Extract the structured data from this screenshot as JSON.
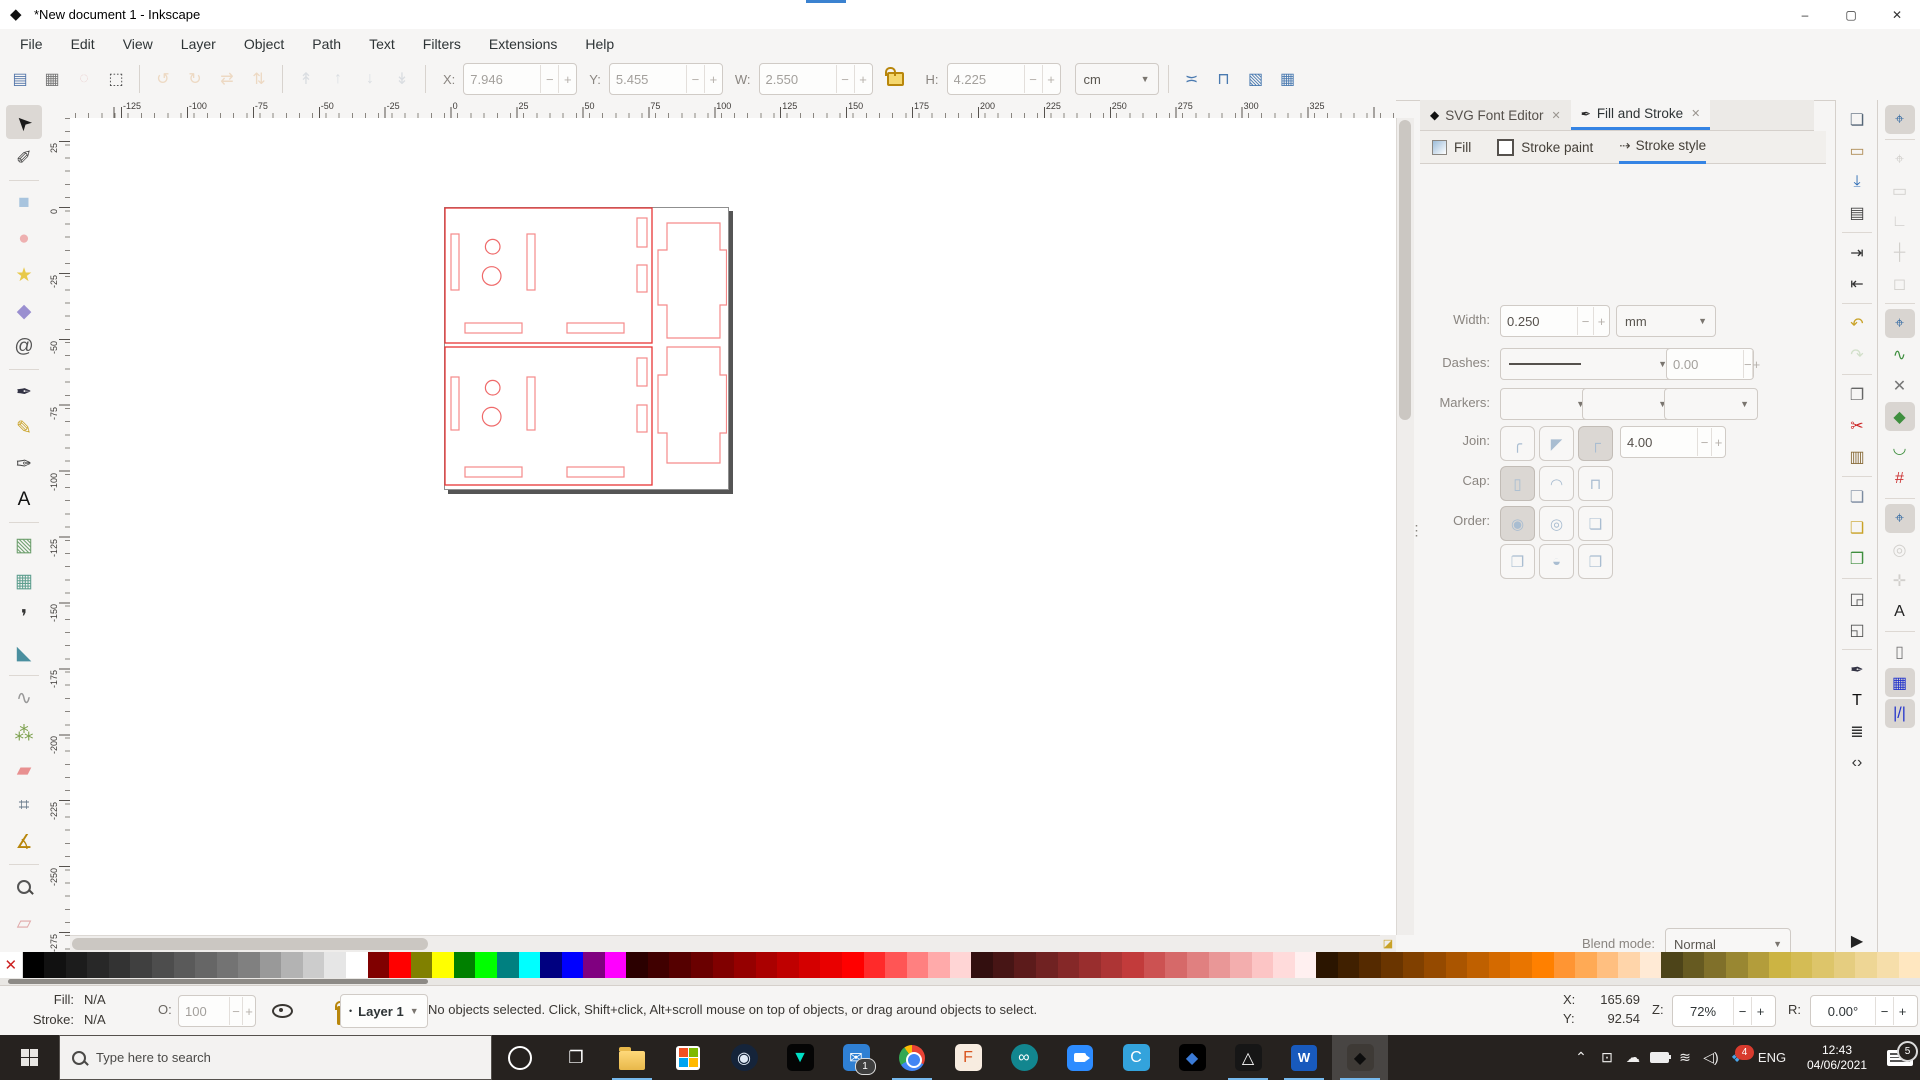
{
  "window": {
    "title": "*New document 1 - Inkscape",
    "minimize": "–",
    "maximize": "▢",
    "close": "✕"
  },
  "menubar": [
    "File",
    "Edit",
    "View",
    "Layer",
    "Object",
    "Path",
    "Text",
    "Filters",
    "Extensions",
    "Help"
  ],
  "toolbar": {
    "select_icons": [
      {
        "name": "select-all-icon",
        "glyph": "▤",
        "color": "#5577aa"
      },
      {
        "name": "select-all-layers-icon",
        "glyph": "▦",
        "color": "#777777"
      },
      {
        "name": "deselect-icon",
        "glyph": "◌",
        "color": "#d9a0a0",
        "disabled": true
      },
      {
        "name": "selection-box-icon",
        "glyph": "⬚",
        "color": "#444444"
      }
    ],
    "transform_icons": [
      {
        "name": "rotate-ccw-icon",
        "glyph": "↺",
        "color": "#e3b98a",
        "disabled": true
      },
      {
        "name": "rotate-cw-icon",
        "glyph": "↻",
        "color": "#e3b98a",
        "disabled": true
      },
      {
        "name": "flip-horizontal-icon",
        "glyph": "⇄",
        "color": "#e3b98a",
        "disabled": true
      },
      {
        "name": "flip-vertical-icon",
        "glyph": "⇅",
        "color": "#e3b98a",
        "disabled": true
      }
    ],
    "arrange_icons": [
      {
        "name": "raise-to-top-icon",
        "glyph": "↟",
        "color": "#b9c2cc",
        "disabled": true
      },
      {
        "name": "raise-icon",
        "glyph": "↑",
        "color": "#b9c2cc",
        "disabled": true
      },
      {
        "name": "lower-icon",
        "glyph": "↓",
        "color": "#b9c2cc",
        "disabled": true
      },
      {
        "name": "lower-to-bottom-icon",
        "glyph": "↡",
        "color": "#b9c2cc",
        "disabled": true
      }
    ],
    "fields": [
      {
        "label": "X:",
        "value": "7.946"
      },
      {
        "label": "Y:",
        "value": "5.455"
      },
      {
        "label": "W:",
        "value": "2.550"
      },
      {
        "label": "H:",
        "value": "4.225"
      }
    ],
    "unit": "cm",
    "affect_icons": [
      {
        "name": "scale-stroke-toggle-icon",
        "glyph": "≍",
        "color": "#4a7ab0"
      },
      {
        "name": "scale-corners-toggle-icon",
        "glyph": "⊓",
        "color": "#4a7ab0"
      },
      {
        "name": "move-gradients-toggle-icon",
        "glyph": "▧",
        "color": "#4a7ab0"
      },
      {
        "name": "move-patterns-toggle-icon",
        "glyph": "▦",
        "color": "#4a7ab0"
      }
    ]
  },
  "rulers": {
    "h_labels": [
      "-125",
      "-100",
      "-75",
      "-50",
      "-25",
      "0",
      "25",
      "50",
      "75",
      "100",
      "125",
      "150",
      "175",
      "200",
      "225",
      "250",
      "275",
      "300",
      "325"
    ],
    "v_labels": [
      "25",
      "0",
      "-25",
      "-50",
      "-75",
      "-100",
      "-125",
      "-150",
      "-175",
      "-200",
      "-225",
      "-250",
      "-275"
    ]
  },
  "toolbox": [
    {
      "name": "selector-tool",
      "glyph": "➤",
      "color": "#1a1a1a",
      "selected": true,
      "rot": true
    },
    {
      "name": "node-tool",
      "glyph": "✐",
      "color": "#444444"
    },
    {
      "sep": true
    },
    {
      "name": "rectangle-tool",
      "glyph": "■",
      "color": "#a8c4de"
    },
    {
      "name": "ellipse-tool",
      "glyph": "●",
      "color": "#eeb0b0"
    },
    {
      "name": "star-tool",
      "glyph": "★",
      "color": "#e8c94a"
    },
    {
      "name": "box3d-tool",
      "glyph": "◆",
      "color": "#9a8fd0"
    },
    {
      "name": "spiral-tool",
      "glyph": "@",
      "color": "#555555"
    },
    {
      "sep": true
    },
    {
      "name": "pen-tool",
      "glyph": "✒",
      "color": "#333344"
    },
    {
      "name": "pencil-tool",
      "glyph": "✎",
      "color": "#c9a227"
    },
    {
      "name": "calligraphy-tool",
      "glyph": "✑",
      "color": "#444444"
    },
    {
      "name": "text-tool",
      "glyph": "A",
      "color": "#111111"
    },
    {
      "sep": true
    },
    {
      "name": "gradient-tool",
      "glyph": "▧",
      "color": "#6fa06f"
    },
    {
      "name": "mesh-tool",
      "glyph": "▦",
      "color": "#5f9f8f"
    },
    {
      "name": "dropper-tool",
      "glyph": "❜",
      "color": "#333333"
    },
    {
      "name": "bucket-tool",
      "glyph": "◣",
      "color": "#4a8f9f"
    },
    {
      "sep": true
    },
    {
      "name": "tweak-tool",
      "glyph": "∿",
      "color": "#999999"
    },
    {
      "name": "spray-tool",
      "glyph": "⁂",
      "color": "#7a9f4a"
    },
    {
      "name": "eraser-tool",
      "glyph": "▰",
      "color": "#e89090"
    },
    {
      "name": "connector-tool",
      "glyph": "⌗",
      "color": "#667788"
    },
    {
      "name": "compass-tool",
      "glyph": "∡",
      "color": "#b8860b"
    },
    {
      "sep": true
    },
    {
      "name": "zoom-tool",
      "glyph": "MAG",
      "color": "#555555"
    },
    {
      "name": "measure-tool",
      "glyph": "▱",
      "color": "#e0a8a8"
    }
  ],
  "drawing": {
    "page_w": 283,
    "page_h": 281,
    "stroke_main": "#e83535",
    "stroke_light": "#f58a8a",
    "stroke_mid": "#ef6a6a",
    "panels": [
      [
        1,
        1,
        207,
        135
      ],
      [
        1,
        140,
        207,
        138
      ]
    ],
    "slots": [
      [
        7,
        27,
        8,
        56
      ],
      [
        83,
        27,
        8,
        56
      ],
      [
        21,
        116,
        57,
        10
      ],
      [
        123,
        116,
        57,
        10
      ],
      [
        193,
        11,
        10,
        29
      ],
      [
        193,
        58,
        10,
        27
      ],
      [
        7,
        170,
        8,
        53
      ],
      [
        83,
        170,
        8,
        53
      ],
      [
        21,
        260,
        57,
        10
      ],
      [
        123,
        260,
        57,
        10
      ],
      [
        193,
        151,
        10,
        28
      ],
      [
        193,
        198,
        10,
        27
      ]
    ],
    "circles": [
      [
        48.7,
        39.7,
        7.3
      ],
      [
        47.7,
        69,
        9.3
      ],
      [
        48.7,
        180.7,
        7.3
      ],
      [
        47.7,
        209.7,
        9.3
      ]
    ],
    "pluses": [
      "M223,16 H276 V43 H282.5 V98 H276 V131 H223 V98 H214 V43 H223 Z",
      "M223,140 H276 V168 H282.5 V226 H276 V256 H223 V226 H214 V168 H223 Z"
    ]
  },
  "dock": {
    "tabs": [
      {
        "label": "SVG Font Editor",
        "icon": "inkscape-logo-icon",
        "icon_glyph": "◆",
        "close": "✕",
        "active": false
      },
      {
        "label": "Fill and Stroke",
        "icon": "fill-stroke-pen-icon",
        "icon_glyph": "✒",
        "close": "✕",
        "active": true
      }
    ],
    "subtabs": [
      {
        "label": "Fill",
        "kind": "grad"
      },
      {
        "label": "Stroke paint",
        "kind": "line"
      },
      {
        "label": "Stroke style",
        "kind": "dash",
        "active": true
      }
    ],
    "stroke": {
      "width_label": "Width:",
      "width_value": "0.250",
      "width_unit": "mm",
      "dashes_label": "Dashes:",
      "dash_offset": "0.00",
      "markers_label": "Markers:",
      "join_label": "Join:",
      "miter_limit": "4.00",
      "join_buttons": [
        {
          "name": "join-round-button",
          "glyph": "╭"
        },
        {
          "name": "join-bevel-button",
          "glyph": "◤"
        },
        {
          "name": "join-miter-button",
          "glyph": "┌",
          "pressed": true
        }
      ],
      "cap_label": "Cap:",
      "cap_buttons": [
        {
          "name": "cap-butt-button",
          "glyph": "▯",
          "pressed": true
        },
        {
          "name": "cap-round-button",
          "glyph": "◠"
        },
        {
          "name": "cap-square-button",
          "glyph": "⊓"
        }
      ],
      "order_label": "Order:",
      "order_buttons": [
        {
          "name": "order-fill-stroke-markers-button",
          "glyph": "◉",
          "pressed": true
        },
        {
          "name": "order-stroke-fill-markers-button",
          "glyph": "◎"
        },
        {
          "name": "order-markers-fill-stroke-button",
          "glyph": "❏"
        },
        {
          "name": "order-fill-markers-stroke-button",
          "glyph": "❐"
        },
        {
          "name": "order-stroke-markers-fill-button",
          "glyph": "◒"
        },
        {
          "name": "order-markers-stroke-fill-button",
          "glyph": "❒"
        }
      ]
    },
    "blend_label": "Blend mode:",
    "blend_value": "Normal",
    "blur_label": "Blur (%)",
    "blur_value": "0.0",
    "opacity_label": "Opacity (%)",
    "opacity_value": "100.0"
  },
  "commands": [
    {
      "name": "new-document-icon",
      "glyph": "❏",
      "color": "#556677"
    },
    {
      "name": "open-document-icon",
      "glyph": "▭",
      "color": "#b08d57"
    },
    {
      "name": "save-document-icon",
      "glyph": "⤓",
      "color": "#2d6cb4"
    },
    {
      "name": "print-icon",
      "glyph": "▤",
      "color": "#444444"
    },
    {
      "sep": true
    },
    {
      "name": "import-icon",
      "glyph": "⇥",
      "color": "#333333"
    },
    {
      "name": "export-icon",
      "glyph": "⇤",
      "color": "#333333"
    },
    {
      "sep": true
    },
    {
      "name": "undo-icon",
      "glyph": "↶",
      "color": "#c9a227"
    },
    {
      "name": "redo-icon",
      "glyph": "↷",
      "color": "#9bbf8a",
      "disabled": true
    },
    {
      "sep": true
    },
    {
      "name": "copy-icon",
      "glyph": "❐",
      "color": "#666666"
    },
    {
      "name": "cut-icon",
      "glyph": "✂",
      "color": "#cc2222"
    },
    {
      "name": "paste-icon",
      "glyph": "▥",
      "color": "#8a6d3b"
    },
    {
      "sep": true
    },
    {
      "name": "duplicate-icon",
      "glyph": "❏",
      "color": "#7a8aa0"
    },
    {
      "name": "clone-icon",
      "glyph": "❑",
      "color": "#c9a227"
    },
    {
      "name": "unlink-clone-icon",
      "glyph": "❒",
      "color": "#3f8f3f"
    },
    {
      "sep": true
    },
    {
      "name": "zoom-selection-icon",
      "glyph": "◲",
      "color": "#555555"
    },
    {
      "name": "zoom-drawing-icon",
      "glyph": "◱",
      "color": "#555555"
    },
    {
      "sep": true
    },
    {
      "name": "fill-stroke-dialog-icon",
      "glyph": "✒",
      "color": "#333344"
    },
    {
      "name": "text-dialog-icon",
      "glyph": "T",
      "color": "#111111"
    },
    {
      "name": "layers-dialog-icon",
      "glyph": "≣",
      "color": "#333333"
    },
    {
      "name": "xml-editor-icon",
      "glyph": "‹›",
      "color": "#333333"
    }
  ],
  "snaps": [
    {
      "name": "snap-enable-icon",
      "glyph": "⌖",
      "color": "#3a6ea5",
      "active": true
    },
    {
      "sep": true
    },
    {
      "name": "snap-bbox-icon",
      "glyph": "⌖",
      "color": "#9c9891",
      "disabled": true
    },
    {
      "name": "snap-bbox-edges-icon",
      "glyph": "▭",
      "color": "#9c9891",
      "disabled": true
    },
    {
      "name": "snap-bbox-corners-icon",
      "glyph": "∟",
      "color": "#9c9891",
      "disabled": true
    },
    {
      "name": "snap-bbox-midpoints-icon",
      "glyph": "┼",
      "color": "#9c9891",
      "disabled": true
    },
    {
      "name": "snap-bbox-centers-icon",
      "glyph": "◻",
      "color": "#9c9891",
      "disabled": true
    },
    {
      "sep": true
    },
    {
      "name": "snap-nodes-icon",
      "glyph": "⌖",
      "color": "#3a6ea5",
      "active": true
    },
    {
      "name": "snap-paths-icon",
      "glyph": "∿",
      "color": "#3f8f3f"
    },
    {
      "name": "snap-path-intersections-icon",
      "glyph": "✕",
      "color": "#777777"
    },
    {
      "name": "snap-cusp-nodes-icon",
      "glyph": "◆",
      "color": "#3f8f3f",
      "active": true
    },
    {
      "name": "snap-smooth-nodes-icon",
      "glyph": "◡",
      "color": "#3f8f3f"
    },
    {
      "name": "snap-midpoints-icon",
      "glyph": "#",
      "color": "#cc3333"
    },
    {
      "sep": true
    },
    {
      "name": "snap-others-icon",
      "glyph": "⌖",
      "color": "#3a6ea5",
      "active": true
    },
    {
      "name": "snap-object-centers-icon",
      "glyph": "◎",
      "color": "#9c9891",
      "disabled": true
    },
    {
      "name": "snap-rotation-centers-icon",
      "glyph": "✛",
      "color": "#9c9891",
      "disabled": true
    },
    {
      "name": "snap-text-baseline-icon",
      "glyph": "A",
      "color": "#222222"
    },
    {
      "sep": true
    },
    {
      "name": "snap-page-border-icon",
      "glyph": "▯",
      "color": "#777777"
    },
    {
      "name": "snap-grid-icon",
      "glyph": "▦",
      "color": "#2233cc",
      "active": true
    },
    {
      "name": "snap-guides-icon",
      "glyph": "|/|",
      "color": "#2233cc",
      "active": true
    }
  ],
  "palette": {
    "none_glyph": "✕",
    "colors": [
      "#000000",
      "#111111",
      "#1c1c1c",
      "#282828",
      "#333333",
      "#404040",
      "#4d4d4d",
      "#5a5a5a",
      "#666666",
      "#737373",
      "#808080",
      "#999999",
      "#b3b3b3",
      "#cccccc",
      "#e6e6e6",
      "#ffffff",
      "#800000",
      "#ff0000",
      "#808000",
      "#ffff00",
      "#008000",
      "#00ff00",
      "#008080",
      "#00ffff",
      "#000080",
      "#0000ff",
      "#800080",
      "#ff00ff",
      "#2b0000",
      "#400000",
      "#550000",
      "#6a0000",
      "#800000",
      "#950000",
      "#aa0000",
      "#bf0000",
      "#d40000",
      "#e90000",
      "#ff0000",
      "#ff2a2a",
      "#ff5555",
      "#ff8080",
      "#ffaaaa",
      "#ffd5d5",
      "#330f0f",
      "#471515",
      "#5c1b1b",
      "#702222",
      "#852828",
      "#992e2e",
      "#ad3535",
      "#c23b3b",
      "#cc5252",
      "#d66969",
      "#e08080",
      "#e99797",
      "#f3aeae",
      "#fcc5c5",
      "#ffdbdb",
      "#fff0f0",
      "#2b1500",
      "#402000",
      "#552a00",
      "#6a3500",
      "#804000",
      "#954a00",
      "#aa5500",
      "#bf6000",
      "#d46a00",
      "#e97500",
      "#ff8000",
      "#ff9533",
      "#ffaa55",
      "#ffbf80",
      "#ffd5aa",
      "#ffead5",
      "#4d4419",
      "#665a21",
      "#80702a",
      "#998732",
      "#b39d3b",
      "#ccb443",
      "#d4bc55",
      "#ddc56a",
      "#e5cd80",
      "#eed695",
      "#f6deaa",
      "#ffe7c0"
    ]
  },
  "statusbar": {
    "fill_label": "Fill:",
    "fill_value": "N/A",
    "stroke_label": "Stroke:",
    "stroke_value": "N/A",
    "o_label": "O:",
    "o_value": "100",
    "layer_value": "Layer 1",
    "message": "No objects selected. Click, Shift+click, Alt+scroll mouse on top of objects, or drag around objects to select.",
    "x_label": "X:",
    "x_value": "165.69",
    "y_label": "Y:",
    "y_value": "92.54",
    "z_label": "Z:",
    "z_value": "72%",
    "r_label": "R:",
    "r_value": "0.00°"
  },
  "taskbar": {
    "search_placeholder": "Type here to search",
    "apps": [
      {
        "name": "file-explorer",
        "kind": "folder",
        "underline": true
      },
      {
        "name": "microsoft-store",
        "kind": "store"
      },
      {
        "name": "steam",
        "glyph": "◉",
        "bg": "#15243a",
        "fg": "#dfe9f5",
        "round": true
      },
      {
        "name": "predator",
        "glyph": "▼",
        "bg": "#050505",
        "fg": "#00e0c6"
      },
      {
        "name": "mail",
        "glyph": "✉",
        "bg": "#2f80d4",
        "fg": "#ffffff",
        "badge": "1"
      },
      {
        "name": "chrome",
        "kind": "chrome",
        "underline": true
      },
      {
        "name": "fusion-360",
        "glyph": "F",
        "bg": "#f7ece0",
        "fg": "#d9541e"
      },
      {
        "name": "arduino",
        "glyph": "∞",
        "bg": "#12868f",
        "fg": "#ffffff",
        "round": true
      },
      {
        "name": "zoom",
        "kind": "zoom"
      },
      {
        "name": "cura",
        "glyph": "C",
        "bg": "#33a3dc",
        "fg": "#ffffff"
      },
      {
        "name": "daz-studio",
        "glyph": "◆",
        "bg": "#000000",
        "fg": "#3b7bd6"
      },
      {
        "name": "prusaslicer",
        "glyph": "△",
        "bg": "#161616",
        "fg": "#fafafa",
        "underline": true
      },
      {
        "name": "word",
        "kind": "word",
        "underline": true
      },
      {
        "name": "inkscape",
        "glyph": "◆",
        "bg": "#3e3a36",
        "fg": "#0d0d0d",
        "active": true
      }
    ],
    "tray": {
      "chevron": "⌃",
      "screen_glyph": "⊡",
      "cloud_glyph": "☁",
      "wifi_glyph": "≋",
      "volume_glyph": "◁)",
      "dropbox_glyph": "❖",
      "dropbox_badge": "4",
      "lang": "ENG",
      "time": "12:43",
      "date": "04/06/2021",
      "notification_badge": "5"
    }
  }
}
